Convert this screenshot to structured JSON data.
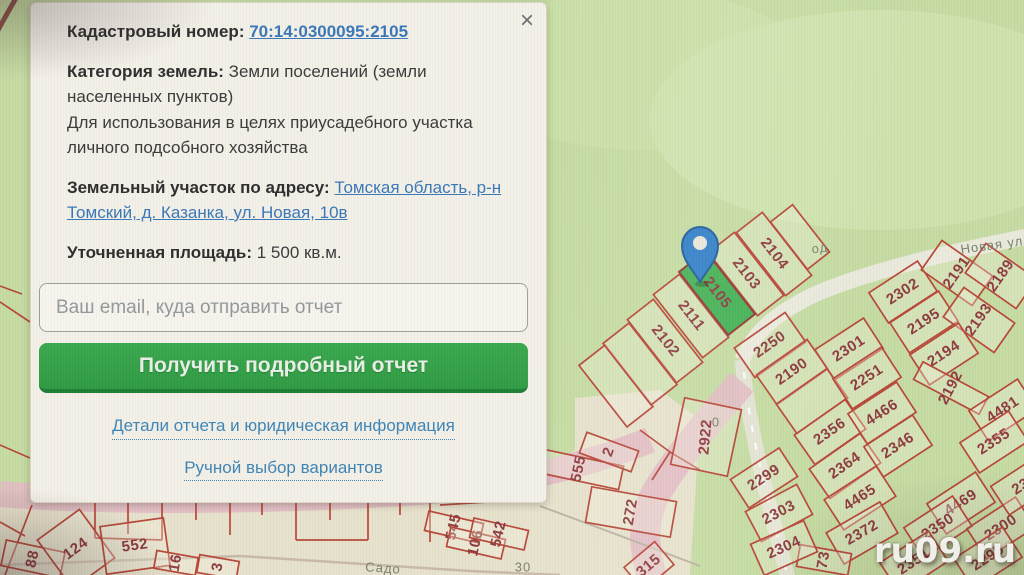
{
  "panel": {
    "close_icon": "×",
    "cadastral": {
      "label": "Кадастровый номер:",
      "value": "70:14:0300095:2105"
    },
    "category": {
      "label": "Категория земель:",
      "text": "Земли поселений (земли населенных пунктов)",
      "usage_line1": "Для использования в целях приусадебного участка",
      "usage_line2": "личного подсобного хозяйства"
    },
    "address": {
      "label": "Земельный участок по адресу:",
      "value": "Томская область, р-н Томский, д. Казанка, ул. Новая, 10в"
    },
    "area": {
      "label": "Уточненная площадь:",
      "value": "1 500 кв.м."
    },
    "email_placeholder": "Ваш email, куда отправить отчет",
    "submit_label": "Получить подробный отчет",
    "details_link": "Детали отчета и юридическая информация",
    "manual_link": "Ручной выбор вариантов"
  },
  "map": {
    "watermark": "ru09.ru",
    "highlight_color": "#46b256",
    "parcel_line_color": "#b8483a",
    "parcel_text_color": "#8e3b40",
    "pin_color": "#3380c8",
    "street_labels": [
      {
        "text": "Новая ул",
        "x": 992,
        "y": 246,
        "rot": -8,
        "fs": 13
      },
      {
        "text": "од",
        "x": 820,
        "y": 249,
        "rot": -8,
        "fs": 11
      },
      {
        "text": "Садо",
        "x": 383,
        "y": 569,
        "rot": 4,
        "fs": 12,
        "color": "#8d897c"
      },
      {
        "text": "30",
        "x": 523,
        "y": 568,
        "rot": 0,
        "fs": 13,
        "color": "#a03c3c"
      },
      {
        "text": "0",
        "x": 716,
        "y": 423,
        "rot": 0,
        "fs": 10,
        "color": "#96а08a"
      }
    ],
    "parcels": [
      {
        "label": "",
        "x": 616,
        "y": 386,
        "lrot": 52,
        "w": 33,
        "h": 78,
        "brot": -38
      },
      {
        "label": "",
        "x": 640,
        "y": 364,
        "lrot": 52,
        "w": 33,
        "h": 78,
        "brot": -38
      },
      {
        "label": "2102",
        "x": 665,
        "y": 341,
        "lrot": 52,
        "w": 33,
        "h": 80,
        "brot": -38
      },
      {
        "label": "2111",
        "x": 691,
        "y": 316,
        "lrot": 52,
        "w": 33,
        "h": 80,
        "brot": -38
      },
      {
        "label": "2103",
        "x": 746,
        "y": 274,
        "lrot": 52,
        "w": 33,
        "h": 80,
        "brot": -38
      },
      {
        "label": "2104",
        "x": 774,
        "y": 254,
        "lrot": 52,
        "w": 33,
        "h": 80,
        "brot": -38
      },
      {
        "label": "",
        "x": 800,
        "y": 237,
        "lrot": 52,
        "w": 28,
        "h": 60,
        "brot": -38
      },
      {
        "label": "2105",
        "x": 717,
        "y": 293,
        "lrot": 52,
        "w": 34,
        "h": 80,
        "brot": -38,
        "hl": true
      },
      {
        "label": "2250",
        "x": 770,
        "y": 345,
        "lrot": -35,
        "w": 62,
        "h": 36,
        "brot": -35
      },
      {
        "label": "2190",
        "x": 792,
        "y": 372,
        "lrot": -35,
        "w": 62,
        "h": 36,
        "brot": -35
      },
      {
        "label": "",
        "x": 812,
        "y": 401,
        "lrot": -35,
        "w": 62,
        "h": 36,
        "brot": -35
      },
      {
        "label": "2356",
        "x": 830,
        "y": 432,
        "lrot": -35,
        "w": 62,
        "h": 36,
        "brot": -35
      },
      {
        "label": "2364",
        "x": 845,
        "y": 466,
        "lrot": -35,
        "w": 62,
        "h": 36,
        "brot": -35
      },
      {
        "label": "4465",
        "x": 860,
        "y": 498,
        "lrot": -33,
        "w": 62,
        "h": 36,
        "brot": -33
      },
      {
        "label": "2372",
        "x": 862,
        "y": 533,
        "lrot": -30,
        "w": 62,
        "h": 36,
        "brot": -30
      },
      {
        "label": "73",
        "x": 824,
        "y": 560,
        "lrot": -80,
        "w": 22,
        "h": 52,
        "brot": -80,
        "fs": 13
      },
      {
        "label": "2299",
        "x": 764,
        "y": 478,
        "lrot": -33,
        "w": 58,
        "h": 34,
        "brot": -33
      },
      {
        "label": "2303",
        "x": 779,
        "y": 513,
        "lrot": -28,
        "w": 58,
        "h": 34,
        "brot": -28
      },
      {
        "label": "2304",
        "x": 784,
        "y": 548,
        "lrot": -24,
        "w": 58,
        "h": 34,
        "brot": -24
      },
      {
        "label": "2302",
        "x": 903,
        "y": 292,
        "lrot": -33,
        "w": 58,
        "h": 36,
        "brot": -33
      },
      {
        "label": "2191",
        "x": 957,
        "y": 273,
        "lrot": -55,
        "w": 36,
        "h": 62,
        "brot": -55
      },
      {
        "label": "2189",
        "x": 1001,
        "y": 276,
        "lrot": -55,
        "w": 36,
        "h": 62,
        "brot": -55
      },
      {
        "label": "2195",
        "x": 924,
        "y": 322,
        "lrot": -33,
        "w": 58,
        "h": 36,
        "brot": -33
      },
      {
        "label": "2193",
        "x": 979,
        "y": 320,
        "lrot": -55,
        "w": 36,
        "h": 62,
        "brot": -55
      },
      {
        "label": "2301",
        "x": 849,
        "y": 349,
        "lrot": -33,
        "w": 58,
        "h": 36,
        "brot": -33
      },
      {
        "label": "2194",
        "x": 944,
        "y": 354,
        "lrot": -33,
        "w": 58,
        "h": 36,
        "brot": -33
      },
      {
        "label": "2251",
        "x": 867,
        "y": 378,
        "lrot": -33,
        "w": 58,
        "h": 36,
        "brot": -33
      },
      {
        "label": "2192",
        "x": 951,
        "y": 388,
        "lrot": -62,
        "w": 20,
        "h": 74,
        "brot": -62,
        "fs": 14
      },
      {
        "label": "4466",
        "x": 882,
        "y": 413,
        "lrot": -33,
        "w": 58,
        "h": 36,
        "brot": -33
      },
      {
        "label": "4481",
        "x": 1003,
        "y": 410,
        "lrot": -33,
        "w": 58,
        "h": 36,
        "brot": -33
      },
      {
        "label": "2346",
        "x": 898,
        "y": 446,
        "lrot": -33,
        "w": 58,
        "h": 36,
        "brot": -33
      },
      {
        "label": "2355",
        "x": 994,
        "y": 442,
        "lrot": -33,
        "w": 58,
        "h": 36,
        "brot": -33
      },
      {
        "label": "4469",
        "x": 961,
        "y": 503,
        "lrot": -33,
        "w": 58,
        "h": 36,
        "brot": -33
      },
      {
        "label": "2350",
        "x": 938,
        "y": 527,
        "lrot": -33,
        "w": 58,
        "h": 36,
        "brot": -33
      },
      {
        "label": "2300",
        "x": 1001,
        "y": 528,
        "lrot": -33,
        "w": 58,
        "h": 36,
        "brot": -33
      },
      {
        "label": "2351",
        "x": 914,
        "y": 562,
        "lrot": -33,
        "w": 58,
        "h": 36,
        "brot": -33
      },
      {
        "label": "2295",
        "x": 988,
        "y": 558,
        "lrot": -33,
        "w": 58,
        "h": 36,
        "brot": -33
      },
      {
        "label": "23",
        "x": 1021,
        "y": 487,
        "lrot": -33,
        "w": 50,
        "h": 34,
        "brot": -33
      },
      {
        "label": "2922",
        "x": 706,
        "y": 437,
        "lrot": -85,
        "w": 58,
        "h": 68,
        "brot": 12,
        "fs": 15
      },
      {
        "label": "88",
        "x": 33,
        "y": 559,
        "lrot": -78,
        "w": 26,
        "h": 60,
        "brot": -78,
        "fs": 14
      },
      {
        "label": "124",
        "x": 76,
        "y": 549,
        "lrot": -36,
        "w": 52,
        "h": 60,
        "brot": -36
      },
      {
        "label": "552",
        "x": 135,
        "y": 546,
        "lrot": -8,
        "w": 64,
        "h": 48,
        "brot": -8
      },
      {
        "label": "16",
        "x": 176,
        "y": 563,
        "lrot": -80,
        "w": 18,
        "h": 42,
        "brot": -80,
        "fs": 13
      },
      {
        "label": "3",
        "x": 218,
        "y": 567,
        "lrot": -80,
        "w": 18,
        "h": 40,
        "brot": -80,
        "fs": 13
      },
      {
        "label": "545",
        "x": 454,
        "y": 527,
        "lrot": -77,
        "w": 20,
        "h": 56,
        "brot": -77,
        "fs": 13
      },
      {
        "label": "106",
        "x": 476,
        "y": 543,
        "lrot": -77,
        "w": 20,
        "h": 56,
        "brot": -77,
        "fs": 13
      },
      {
        "label": "542",
        "x": 499,
        "y": 534,
        "lrot": -77,
        "w": 20,
        "h": 56,
        "brot": -77,
        "fs": 13
      },
      {
        "label": "555",
        "x": 579,
        "y": 469,
        "lrot": -78,
        "w": 24,
        "h": 86,
        "brot": -78,
        "fs": 14
      },
      {
        "label": "2",
        "x": 609,
        "y": 452,
        "lrot": -70,
        "w": 22,
        "h": 55,
        "brot": -70,
        "fs": 13
      },
      {
        "label": "272",
        "x": 631,
        "y": 512,
        "lrot": -80,
        "w": 36,
        "h": 86,
        "brot": -80
      },
      {
        "label": "315",
        "x": 649,
        "y": 566,
        "lrot": -40,
        "w": 40,
        "h": 30,
        "brot": -40,
        "fs": 13
      }
    ]
  }
}
